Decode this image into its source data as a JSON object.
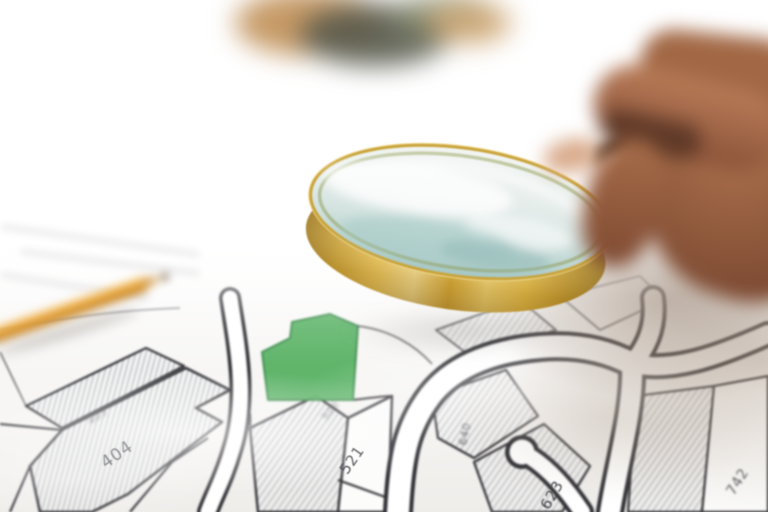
{
  "scene": {
    "type": "photograph",
    "objects": [
      "magnifying-glass",
      "hand",
      "pencil",
      "cadastral-map",
      "highlighted-parcel"
    ]
  },
  "map": {
    "kind": "cadastral-parcel-map",
    "parcels": [
      {
        "label": "403"
      },
      {
        "label": "404"
      },
      {
        "label": "520"
      },
      {
        "label": "521"
      },
      {
        "label": "640"
      },
      {
        "label": "623"
      },
      {
        "label": "742"
      }
    ]
  },
  "colors": {
    "parcel_highlight_green": "#58b264",
    "map_line": "#2f2f34",
    "road_fill": "#ffffff",
    "magnifier_rim_gold": "#e2bd54",
    "lens_tint": "#bcd5d2",
    "pencil_orange": "#eaa53c",
    "hand_skin": "#a0684a",
    "handle_brown": "#3a2a20"
  }
}
